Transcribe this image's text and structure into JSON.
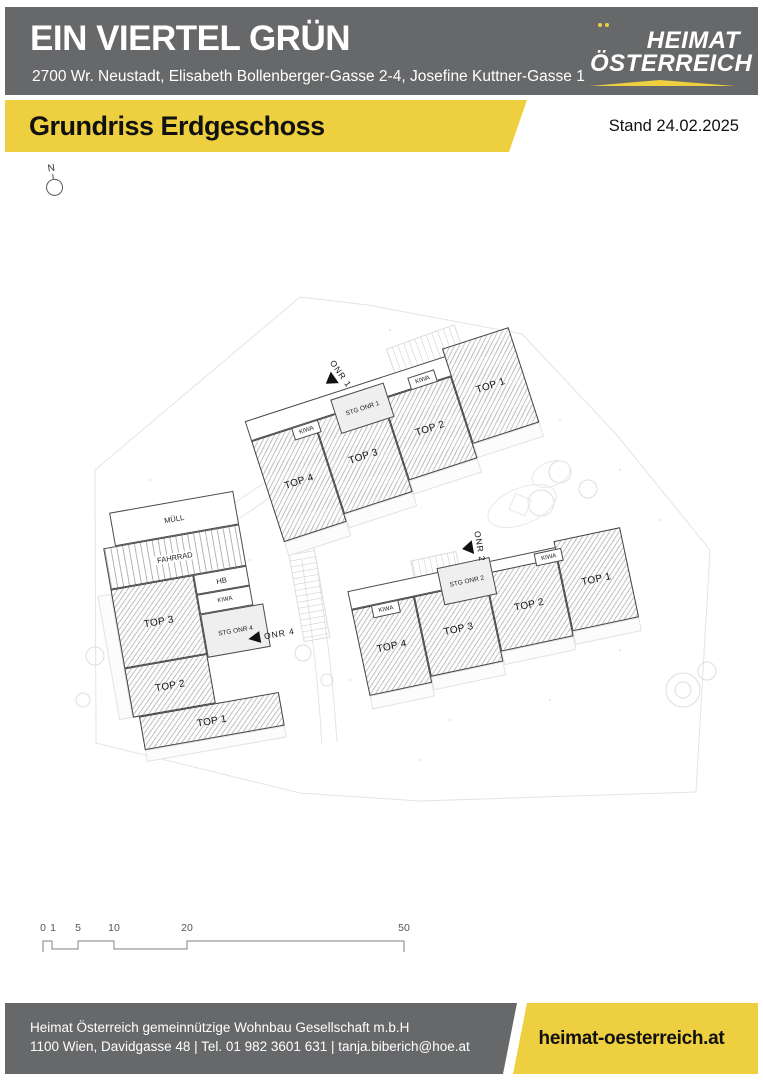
{
  "header": {
    "title": "EIN VIERTEL GRÜN",
    "address": "2700 Wr. Neustadt, Elisabeth Bollenberger-Gasse 2-4, Josefine Kuttner-Gasse 1",
    "logo_line1": "HEIMAT",
    "logo_line2": "ÖSTERREICH"
  },
  "banner": {
    "title": "Grundriss Erdgeschoss",
    "date": "Stand 24.02.2025"
  },
  "compass_label": "N",
  "plan": {
    "onr1": {
      "arrow": "ONR 1",
      "stg": "STG ONR 1",
      "kiwa_left": "KIWA",
      "kiwa_right": "KIWA",
      "top4": "TOP 4",
      "top3": "TOP 3",
      "top2": "TOP 2",
      "top1": "TOP 1"
    },
    "onr2": {
      "arrow": "ONR 2",
      "stg": "STG ONR 2",
      "kiwa_left": "KIWA",
      "kiwa_right": "KIWA",
      "top4": "TOP 4",
      "top3": "TOP 3",
      "top2": "TOP 2",
      "top1": "TOP 1"
    },
    "onr4": {
      "arrow": "ONR 4",
      "stg": "STG ONR 4",
      "muell": "MÜLL",
      "fahrrad": "FAHRRAD",
      "hb": "HB",
      "kiwa": "KIWA",
      "top3": "TOP 3",
      "top2": "TOP 2",
      "top1": "TOP 1"
    }
  },
  "scalebar": {
    "labels": [
      "0",
      "1",
      "5",
      "10",
      "20",
      "50"
    ]
  },
  "footer": {
    "line1": "Heimat Österreich gemeinnützige Wohnbau Gesellschaft m.b.H",
    "line2": "1100 Wien, Davidgasse 48 | Tel. 01 982 3601 631 | tanja.biberich@hoe.at",
    "website": "heimat-oesterreich.at"
  },
  "colors": {
    "brand_yellow": "#eecf3f",
    "brand_gray": "#67686a"
  }
}
